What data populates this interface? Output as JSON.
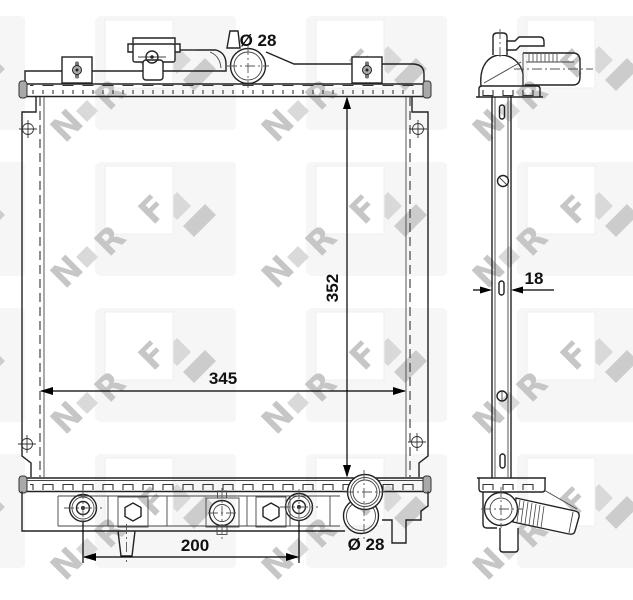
{
  "drawing": {
    "brand": "NRF",
    "subject": "radiator technical drawing, front and side views",
    "dimensions": {
      "top_inlet_diameter": "Ø 28",
      "core_height": "352",
      "core_width": "345",
      "mount_spacing": "200",
      "bottom_outlet_diameter": "Ø 28",
      "core_depth": "18"
    }
  },
  "watermark": {
    "letters": [
      "N",
      "R",
      "F"
    ]
  },
  "colors": {
    "line": "#222222",
    "dimension_text": "#111111",
    "watermark_shape": "#d9d9d9",
    "watermark_letter": "#c6c6c6",
    "background": "#ffffff"
  }
}
